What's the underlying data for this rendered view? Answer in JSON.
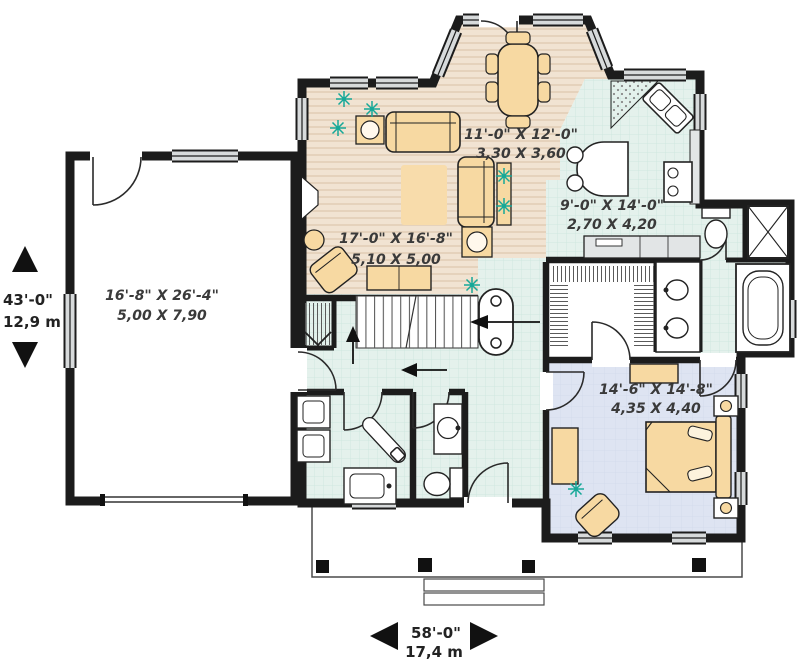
{
  "rooms": {
    "garage": {
      "imperial": "16'-8\" X 26'-4\"",
      "metric": "5,00 X 7,90"
    },
    "living_room": {
      "imperial": "17'-0\" X 16'-8\"",
      "metric": "5,10 X 5,00"
    },
    "dining_room": {
      "imperial": "11'-0\" X 12'-0\"",
      "metric": "3,30 X 3,60"
    },
    "kitchen": {
      "imperial": "9'-0\" X 14'-0\"",
      "metric": "2,70 X 4,20"
    },
    "master_bedroom": {
      "imperial": "14'-6\" X 14'-8\"",
      "metric": "4,35 X 4,40"
    }
  },
  "overall_dimensions": {
    "depth": {
      "imperial": "43'-0\"",
      "metric": "12,9 m"
    },
    "width": {
      "imperial": "58'-0\"",
      "metric": "17,4 m"
    }
  },
  "colors": {
    "wall": "#1c1c1c",
    "wood_floor": "#f1e3d2",
    "tile_floor": "#e4f1ec",
    "bedroom_floor": "#dee4f2",
    "furniture": "#f7d9a2",
    "plant": "#16a898",
    "window_fill": "#d7dadb",
    "label_text": "#3a3a3a"
  }
}
